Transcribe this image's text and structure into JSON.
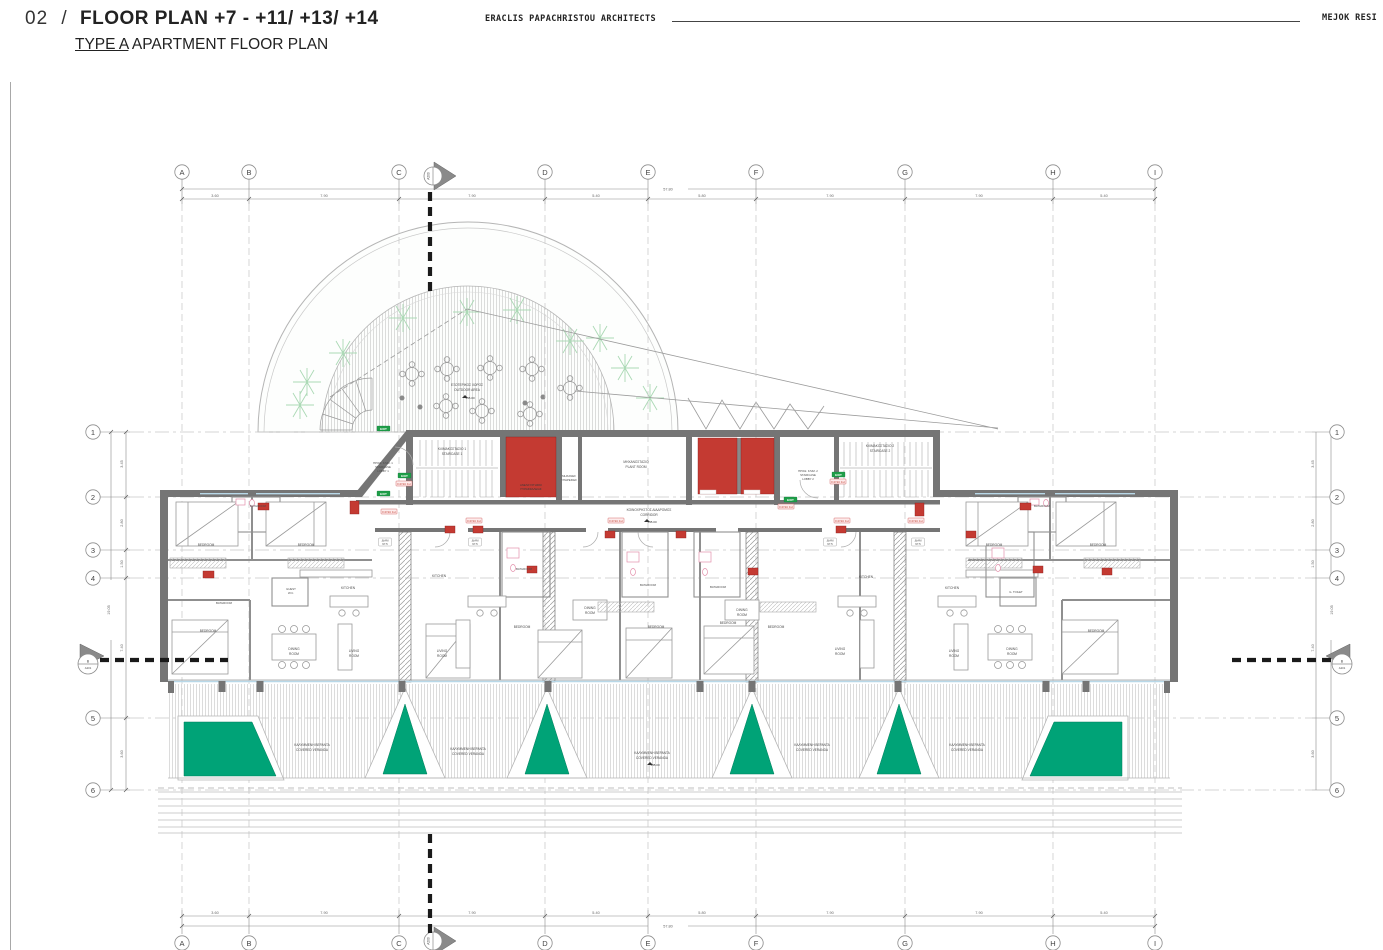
{
  "header": {
    "num": "02",
    "slash": "/",
    "title": "FLOOR PLAN +7 - +11/ +13/ +14",
    "type_label": "TYPE A",
    "subtitle": " APARTMENT FLOOR PLAN",
    "architect": "ERACLIS PAPACHRISTOU ARCHITECTS",
    "project": "MEJOK RESI"
  },
  "grid": {
    "cols": [
      "A",
      "B",
      "C",
      "D",
      "E",
      "F",
      "G",
      "H",
      "I"
    ],
    "rows": [
      "1",
      "2",
      "3",
      "4",
      "5",
      "6"
    ],
    "top_dims": [
      "3.60",
      "7.90",
      "7.90",
      "5.40",
      "5.80",
      "7.90",
      "7.90",
      "5.40"
    ],
    "top_total": "57.80",
    "left_dims": [
      "3.45",
      "2.80",
      "1.50",
      "7.40",
      "3.60"
    ],
    "left_total": "19.05"
  },
  "sections": {
    "top_sheet": "A200",
    "side_name": "B",
    "side_sheet": "A201"
  },
  "levels": {
    "main": "+45.00"
  },
  "tags": {
    "exit": "EXIT",
    "fire": "F.R.SC 1H",
    "area_l1": "ΔΙΑΜ",
    "area_l2": "97.5"
  },
  "rooms": {
    "bedroom": "BEDROOM",
    "bathroom": "BATHROOM",
    "kitchen": "KITCHEN",
    "living1": "LIVING",
    "living2": "ROOM",
    "dining1": "DINING",
    "dining2": "ROOM",
    "guest1": "GUEST",
    "guest2": "W.C.",
    "gtoilet": "G. TOILET",
    "stair1_el": "ΚΛΙΜΑΚΟΣΤΑΣΙΟ 1",
    "stair1_en": "STAIRCASE 1",
    "stair2_el": "ΚΛΙΜΑΚΟΣΤΑΣΙΟ 2",
    "stair2_en": "STAIRCASE 2",
    "lobby1_1": "ΠΡΟΘ. ΚΛΙΜ. 1",
    "lobby1_2": "STAIRCASE",
    "lobby1_3": "LOBBY 1",
    "lobby2_1": "ΠΡΟΘ. ΚΛΙΜ. 2",
    "lobby2_2": "STAIRCASE",
    "lobby2_3": "LOBBY 2",
    "firelift1": "ΑΝΕΛΚΥΣΤΗΡΑΣ",
    "firelift2": "ΠΥΡΑΣΦΑΛΕΙΑΣ",
    "services1": "ΜΗΧΑΝΕΣ",
    "services2": "ΥΠΗΡΕΣΙΕΣ",
    "plant_el": "ΜΗΧΑΝΟΣΤΑΣΙΟ",
    "plant_en": "PLANT ROOM",
    "corridor_el": "ΚΟΙΝΟΧΡΗΣΤΟΣ ΔΙΑΔΡΟΜΟΣ",
    "corridor_en": "CORRIDOR",
    "veranda_el": "ΚΑΛΥΜΜΕΝΗ ΒΕΡΑΝΤΑ",
    "veranda_en": "COVERED VERANDA",
    "outdoor_el": "ΕΞΩΤΕΡΙΚΟΣ ΧΩΡΟΣ",
    "outdoor_en": "OUTDOOR AREA"
  },
  "colors": {
    "wall": "#757575",
    "elevator_red": "#c43a32",
    "planter_green": "#00a377",
    "tree_green": "#abd9b5",
    "exit_green": "#1f9e48",
    "fire_tag_red": "#c0392b",
    "glass_blue": "#b8d8e8"
  }
}
